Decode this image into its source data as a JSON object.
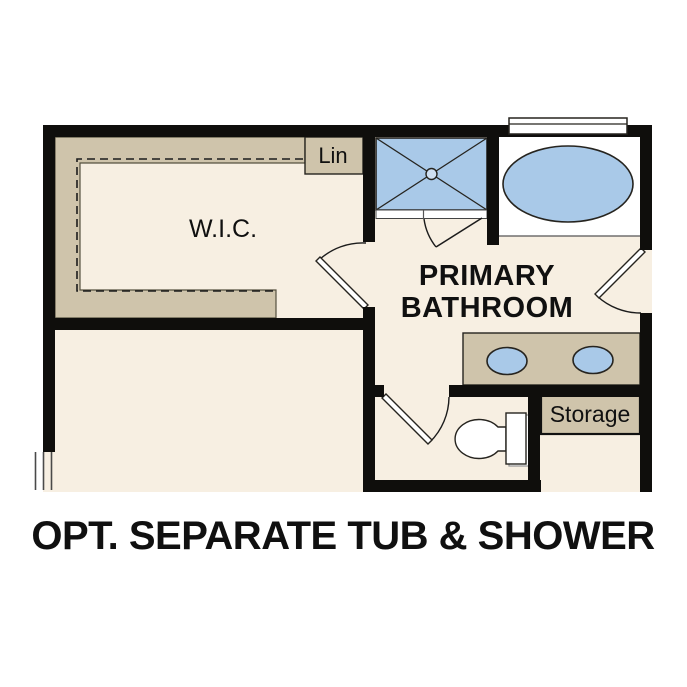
{
  "title": {
    "text": "OPT. SEPARATE TUB & SHOWER"
  },
  "plan": {
    "rooms": {
      "wic": {
        "label": "W.I.C."
      },
      "primary_bathroom": {
        "label": [
          "PRIMARY",
          "BATHROOM"
        ]
      },
      "lin_closet": {
        "label": "Lin"
      },
      "storage": {
        "label": "Storage"
      }
    },
    "fixtures": {
      "shower": "walk-in-shower-with-glass-door",
      "tub": "oval-soaking-tub-under-window",
      "vanity": "double-sink-vanity",
      "toilet": "toilet",
      "closet_rod": "dashed-shelf-and-rod",
      "windows": [
        "window-above-tub",
        "window-left-wall"
      ],
      "doors": [
        "wic-door",
        "shower-door",
        "bathroom-entry-door",
        "toilet-room-door"
      ]
    },
    "colors": {
      "floor": "#f7efe2",
      "cabinet": "#cfc4ab",
      "fixture": "#a9c9e8",
      "wall": "#0f0e0c",
      "line": "#26241f",
      "background": "#ffffff"
    }
  }
}
